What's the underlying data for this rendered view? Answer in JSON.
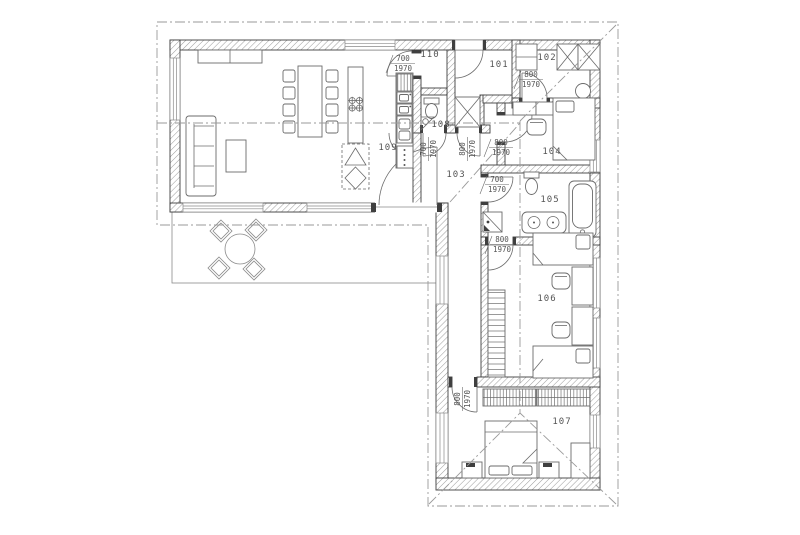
{
  "drawing": {
    "type": "architectural floor plan, single storey L-shaped house"
  },
  "rooms": {
    "r101": "101",
    "r102": "102",
    "r103": "103",
    "r104": "104",
    "r105": "105",
    "r106": "106",
    "r107": "107",
    "r108": "108",
    "r109": "109",
    "r110": "110"
  },
  "doors": {
    "pantry": {
      "w": "700",
      "h": "1970"
    },
    "wc": {
      "w": "700",
      "h": "1970"
    },
    "hall": {
      "w": "800",
      "h": "1970"
    },
    "closet": {
      "w": "800",
      "h": "1970"
    },
    "bedroom104": {
      "w": "800",
      "h": "1970"
    },
    "bath105": {
      "w": "700",
      "h": "1970"
    },
    "room106": {
      "w": "800",
      "h": "1970"
    },
    "room107": {
      "w": "800",
      "h": "1970"
    }
  },
  "colors": {
    "wall_line": "#3f3f3f",
    "hatch": "#9a9a9a",
    "furniture": "#6b6b6b",
    "dash": "#9a9a9a",
    "text": "#555555",
    "background": "#ffffff"
  }
}
